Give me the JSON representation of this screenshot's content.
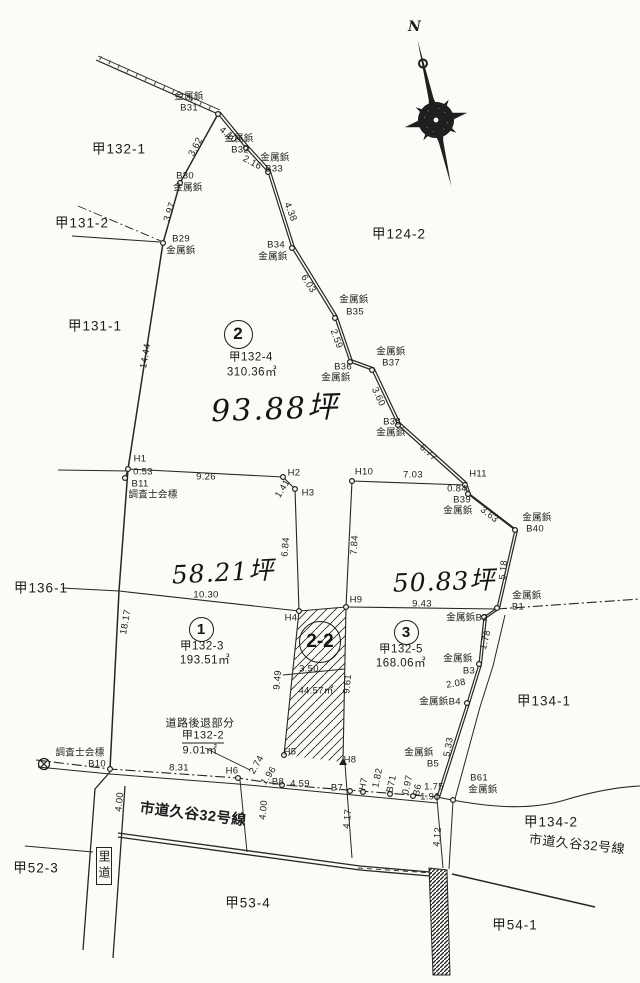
{
  "colors": {
    "ink": "#262626",
    "paper": "#fbfbf8"
  },
  "compass": {
    "north_label": "N"
  },
  "parcels": [
    {
      "badge": "2",
      "lot_number": "甲132-4",
      "area_m2": "310.36㎡",
      "area_tsubo": "93.88坪"
    },
    {
      "badge": "1",
      "lot_number": "甲132-3",
      "area_m2": "193.51㎡",
      "area_tsubo": "58.21坪"
    },
    {
      "badge": "3",
      "lot_number": "甲132-5",
      "area_m2": "168.06㎡",
      "area_tsubo": "50.83坪"
    },
    {
      "badge": "2-2",
      "area_m2": "44.57㎡"
    },
    {
      "name": "道路後退部分",
      "lot_number": "甲132-2",
      "area_m2": "9.01㎡"
    }
  ],
  "roads": [
    "市道久谷32号線",
    "里道"
  ],
  "neighbor_lots": [
    "甲132-1",
    "甲131-2",
    "甲131-1",
    "甲124-2",
    "甲136-1",
    "甲134-1",
    "甲134-2",
    "甲52-3",
    "甲53-4",
    "甲54-1"
  ],
  "marker_types": [
    "金属鋲",
    "調査士会標"
  ],
  "parcel_badges": [
    {
      "t": "2",
      "x": 237,
      "y": 333,
      "d": 27,
      "fs": 17
    },
    {
      "t": "1",
      "x": 200,
      "y": 628,
      "d": 23,
      "fs": 15
    },
    {
      "t": "3",
      "x": 405,
      "y": 631,
      "d": 23,
      "fs": 15
    },
    {
      "t": "2-2",
      "x": 319,
      "y": 641,
      "d": 40,
      "fs": 19
    }
  ],
  "labels": [
    {
      "t": "金属鋲",
      "x": 189,
      "y": 97
    },
    {
      "t": "B31",
      "x": 189,
      "y": 108
    },
    {
      "t": "金属鋲",
      "x": 239,
      "y": 139
    },
    {
      "t": "B32",
      "x": 240,
      "y": 150
    },
    {
      "t": "金属鋲",
      "x": 275,
      "y": 158
    },
    {
      "t": "B33",
      "x": 274,
      "y": 169
    },
    {
      "t": "B30",
      "x": 185,
      "y": 176
    },
    {
      "t": "金属鋲",
      "x": 188,
      "y": 188
    },
    {
      "t": "B29",
      "x": 181,
      "y": 239
    },
    {
      "t": "金属鋲",
      "x": 181,
      "y": 251
    },
    {
      "t": "B34",
      "x": 276,
      "y": 245
    },
    {
      "t": "金属鋲",
      "x": 273,
      "y": 257
    },
    {
      "t": "金属鋲",
      "x": 354,
      "y": 300
    },
    {
      "t": "B35",
      "x": 355,
      "y": 312
    },
    {
      "t": "金属鋲",
      "x": 391,
      "y": 352
    },
    {
      "t": "B37",
      "x": 391,
      "y": 363
    },
    {
      "t": "B36",
      "x": 343,
      "y": 367
    },
    {
      "t": "金属鋲",
      "x": 336,
      "y": 378
    },
    {
      "t": "B38",
      "x": 392,
      "y": 422
    },
    {
      "t": "金属鋲",
      "x": 391,
      "y": 433
    },
    {
      "t": "3.62",
      "x": 196,
      "y": 147,
      "r": -62
    },
    {
      "t": "3.97",
      "x": 170,
      "y": 212,
      "r": -72
    },
    {
      "t": "4.10",
      "x": 228,
      "y": 135,
      "r": 38
    },
    {
      "t": "2.16",
      "x": 252,
      "y": 163,
      "r": 28
    },
    {
      "t": "4.38",
      "x": 290,
      "y": 212,
      "r": 68
    },
    {
      "t": "6.03",
      "x": 308,
      "y": 284,
      "r": 58
    },
    {
      "t": "2.59",
      "x": 336,
      "y": 339,
      "r": 70
    },
    {
      "t": "3.60",
      "x": 378,
      "y": 397,
      "r": 65
    },
    {
      "t": "6.77",
      "x": 428,
      "y": 453,
      "r": 42
    },
    {
      "t": "14.44",
      "x": 146,
      "y": 356,
      "r": -80
    },
    {
      "t": "H1",
      "x": 140,
      "y": 459
    },
    {
      "t": "0.53",
      "x": 143,
      "y": 472
    },
    {
      "t": "B11",
      "x": 140,
      "y": 484
    },
    {
      "t": "調査士会標",
      "x": 153,
      "y": 495
    },
    {
      "t": "9.26",
      "x": 206,
      "y": 477
    },
    {
      "t": "H2",
      "x": 294,
      "y": 473
    },
    {
      "t": "1.41",
      "x": 283,
      "y": 489,
      "r": -58
    },
    {
      "t": "H3",
      "x": 308,
      "y": 493
    },
    {
      "t": "6.84",
      "x": 286,
      "y": 547,
      "r": -85
    },
    {
      "t": "H10",
      "x": 364,
      "y": 472
    },
    {
      "t": "7.03",
      "x": 413,
      "y": 475
    },
    {
      "t": "H11",
      "x": 478,
      "y": 474
    },
    {
      "t": "0.84",
      "x": 457,
      "y": 489
    },
    {
      "t": "B39",
      "x": 462,
      "y": 500
    },
    {
      "t": "金属鋲",
      "x": 458,
      "y": 511
    },
    {
      "t": "3.63",
      "x": 489,
      "y": 515,
      "r": 38
    },
    {
      "t": "金属鋲",
      "x": 537,
      "y": 518
    },
    {
      "t": "B40",
      "x": 535,
      "y": 529
    },
    {
      "t": "5.18",
      "x": 504,
      "y": 570,
      "r": -84
    },
    {
      "t": "7.84",
      "x": 355,
      "y": 545,
      "r": -87
    },
    {
      "t": "10.30",
      "x": 206,
      "y": 595
    },
    {
      "t": "18.17",
      "x": 126,
      "y": 622,
      "r": -80
    },
    {
      "t": "H4",
      "x": 291,
      "y": 618
    },
    {
      "t": "H9",
      "x": 356,
      "y": 600
    },
    {
      "t": "9.43",
      "x": 422,
      "y": 604
    },
    {
      "t": "9.49",
      "x": 278,
      "y": 680,
      "r": -85
    },
    {
      "t": "3.50",
      "x": 309,
      "y": 669
    },
    {
      "t": "44.57㎡",
      "x": 316,
      "y": 691
    },
    {
      "t": "9.61",
      "x": 348,
      "y": 684,
      "r": -84
    },
    {
      "t": "金属鋲",
      "x": 527,
      "y": 596
    },
    {
      "t": "B1",
      "x": 518,
      "y": 607
    },
    {
      "t": "金属鋲B2",
      "x": 467,
      "y": 618
    },
    {
      "t": "1.78",
      "x": 486,
      "y": 640,
      "r": -76
    },
    {
      "t": "金属鋲",
      "x": 458,
      "y": 659
    },
    {
      "t": "B3",
      "x": 469,
      "y": 671
    },
    {
      "t": "2.08",
      "x": 456,
      "y": 684,
      "r": -10
    },
    {
      "t": "金属鋲B4",
      "x": 440,
      "y": 702
    },
    {
      "t": "5.33",
      "x": 449,
      "y": 747,
      "r": -80
    },
    {
      "t": "調査士会標",
      "x": 80,
      "y": 753
    },
    {
      "t": "B10",
      "x": 97,
      "y": 764
    },
    {
      "t": "8.31",
      "x": 179,
      "y": 768
    },
    {
      "t": "H6",
      "x": 232,
      "y": 771
    },
    {
      "t": "2.74",
      "x": 257,
      "y": 765,
      "r": -60
    },
    {
      "t": "H5",
      "x": 290,
      "y": 752
    },
    {
      "t": "1.96",
      "x": 269,
      "y": 776,
      "r": -55
    },
    {
      "t": "B8",
      "x": 278,
      "y": 782
    },
    {
      "t": "4.59",
      "x": 300,
      "y": 784
    },
    {
      "t": "H8",
      "x": 350,
      "y": 760
    },
    {
      "t": "B7",
      "x": 337,
      "y": 788
    },
    {
      "t": "H7",
      "x": 364,
      "y": 784,
      "r": -78
    },
    {
      "t": "1.82",
      "x": 378,
      "y": 778,
      "r": -78
    },
    {
      "t": "B71",
      "x": 392,
      "y": 784,
      "r": -78
    },
    {
      "t": "0.97",
      "x": 408,
      "y": 785,
      "r": -78
    },
    {
      "t": "B6",
      "x": 418,
      "y": 790,
      "r": -78
    },
    {
      "t": "1.75",
      "x": 434,
      "y": 787
    },
    {
      "t": "1.91",
      "x": 430,
      "y": 797
    },
    {
      "t": "金属鋲",
      "x": 419,
      "y": 753
    },
    {
      "t": "B5",
      "x": 433,
      "y": 764
    },
    {
      "t": "B61",
      "x": 479,
      "y": 778
    },
    {
      "t": "金属鋲",
      "x": 483,
      "y": 790
    },
    {
      "t": "4.17",
      "x": 348,
      "y": 819,
      "r": -84
    },
    {
      "t": "4.12",
      "x": 438,
      "y": 837,
      "r": -84
    },
    {
      "t": "4.00",
      "x": 120,
      "y": 802,
      "r": -84
    },
    {
      "t": "4.00",
      "x": 264,
      "y": 810,
      "r": -84
    },
    {
      "t": "甲132-1",
      "c": "b",
      "x": 119,
      "y": 149
    },
    {
      "t": "甲131-2",
      "c": "b",
      "x": 82,
      "y": 223
    },
    {
      "t": "甲131-1",
      "c": "b",
      "x": 95,
      "y": 326
    },
    {
      "t": "甲124-2",
      "c": "b",
      "x": 399,
      "y": 234
    },
    {
      "t": "甲136-1",
      "c": "b",
      "x": 41,
      "y": 588
    },
    {
      "t": "甲134-1",
      "c": "b",
      "x": 544,
      "y": 701
    },
    {
      "t": "甲134-2",
      "c": "b",
      "x": 551,
      "y": 822
    },
    {
      "t": "市道久谷32号線",
      "c": "road2",
      "x": 577,
      "y": 844,
      "r": 6
    },
    {
      "t": "甲52-3",
      "c": "b",
      "x": 36,
      "y": 868
    },
    {
      "t": "甲53-4",
      "c": "b",
      "x": 248,
      "y": 903
    },
    {
      "t": "甲54-1",
      "c": "b",
      "x": 515,
      "y": 925
    },
    {
      "t": "市道久谷32号線",
      "c": "road",
      "x": 193,
      "y": 815,
      "r": 7
    },
    {
      "t": "甲132-4",
      "c": "m",
      "x": 251,
      "y": 358
    },
    {
      "t": "310.36㎡",
      "c": "m",
      "x": 252,
      "y": 373
    },
    {
      "t": "93.88坪",
      "c": "hand",
      "x": 275,
      "y": 406,
      "r": -2
    },
    {
      "t": "58.21坪",
      "c": "hand2",
      "x": 223,
      "y": 571,
      "r": -3
    },
    {
      "t": "50.83坪",
      "c": "hand2",
      "x": 444,
      "y": 580,
      "r": -2
    },
    {
      "t": "甲132-3",
      "c": "m",
      "x": 202,
      "y": 647
    },
    {
      "t": "193.51㎡",
      "c": "m",
      "x": 205,
      "y": 661
    },
    {
      "t": "甲132-5",
      "c": "m",
      "x": 401,
      "y": 650
    },
    {
      "t": "168.06㎡",
      "c": "m",
      "x": 401,
      "y": 664
    },
    {
      "t": "道路後退部分",
      "c": "m2",
      "x": 200,
      "y": 724
    },
    {
      "t": "甲132-2",
      "c": "m2 u",
      "x": 203,
      "y": 737
    },
    {
      "t": "9.01㎡",
      "c": "m2",
      "x": 200,
      "y": 751
    },
    {
      "t": "里道",
      "c": "rido",
      "x": 104,
      "y": 866
    }
  ],
  "markers": {
    "circles": [
      [
        218,
        114
      ],
      [
        246,
        148
      ],
      [
        268,
        172
      ],
      [
        292,
        248
      ],
      [
        335,
        318
      ],
      [
        350,
        362
      ],
      [
        372,
        370
      ],
      [
        398,
        425
      ],
      [
        465,
        485
      ],
      [
        468,
        494
      ],
      [
        515,
        530
      ],
      [
        497,
        608
      ],
      [
        484,
        617
      ],
      [
        479,
        664
      ],
      [
        467,
        703
      ],
      [
        437,
        797
      ],
      [
        453,
        800
      ],
      [
        180,
        183
      ],
      [
        163,
        243
      ],
      [
        128,
        469
      ],
      [
        125,
        478
      ],
      [
        283,
        477
      ],
      [
        295,
        489
      ],
      [
        352,
        481
      ],
      [
        299,
        611
      ],
      [
        346,
        607
      ],
      [
        284,
        755
      ],
      [
        238,
        778
      ],
      [
        110,
        769
      ],
      [
        282,
        785
      ],
      [
        350,
        791
      ],
      [
        363,
        792
      ],
      [
        390,
        794
      ],
      [
        413,
        796
      ]
    ],
    "triangles": [
      [
        343,
        762
      ]
    ],
    "benchmark": {
      "x": 44,
      "y": 764
    }
  }
}
